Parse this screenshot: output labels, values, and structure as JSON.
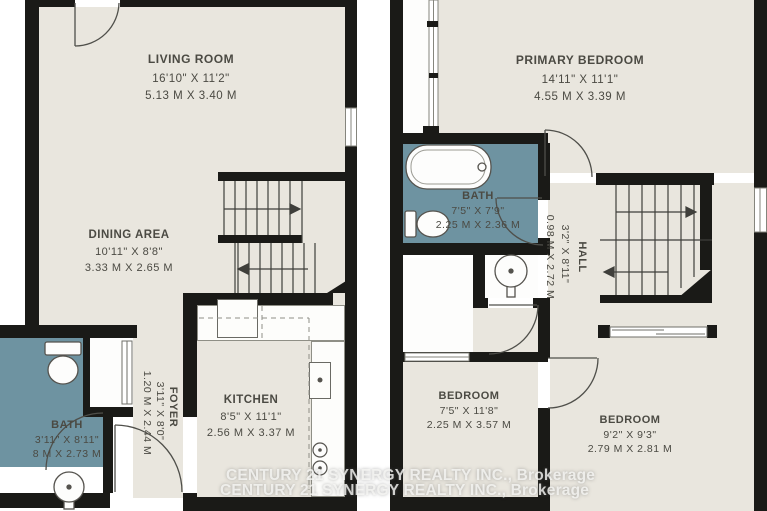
{
  "colors": {
    "floor": "#e9e6de",
    "wall": "#1a1a17",
    "bath_tile": "#6e93a1",
    "label_text": "#4b4a43",
    "watermark": "#f6f6f4"
  },
  "watermark": {
    "line1": "CENTURY 21 SYNERGY REALTY INC., Brokerage",
    "line2": "CENTURY 21 SYNERGY REALTY INC., Brokerage"
  },
  "floors": {
    "main": {
      "rooms": [
        {
          "id": "living-room",
          "name": "LIVING ROOM",
          "imperial": "16'10\" X 11'2\"",
          "metric": "5.13 M X 3.40 M"
        },
        {
          "id": "dining-area",
          "name": "DINING AREA",
          "imperial": "10'11\" X 8'8\"",
          "metric": "3.33 M X 2.65 M"
        },
        {
          "id": "kitchen",
          "name": "KITCHEN",
          "imperial": "8'5\" X 11'1\"",
          "metric": "2.56 M X 3.37 M"
        },
        {
          "id": "bath",
          "name": "BATH",
          "imperial": "3'11\" X 8'11\"",
          "metric": "8 M X 2.73 M"
        },
        {
          "id": "foyer",
          "name": "FOYER",
          "imperial": "3'11\" X 8'0\"",
          "metric": "1.20 M X 2.44 M"
        }
      ]
    },
    "upper": {
      "rooms": [
        {
          "id": "primary-bedroom",
          "name": "PRIMARY BEDROOM",
          "imperial": "14'11\" X 11'1\"",
          "metric": "4.55 M X 3.39 M"
        },
        {
          "id": "bath",
          "name": "BATH",
          "imperial": "7'5\" X 7'9\"",
          "metric": "2.25 M X 2.36 M"
        },
        {
          "id": "hall",
          "name": "HALL",
          "imperial": "3'2\" X 8'11\"",
          "metric": "0.98 M X 2.72 M"
        },
        {
          "id": "bedroom-middle",
          "name": "BEDROOM",
          "imperial": "7'5\" X 11'8\"",
          "metric": "2.25 M X 3.57 M"
        },
        {
          "id": "bedroom-right",
          "name": "BEDROOM",
          "imperial": "9'2\" X 9'3\"",
          "metric": "2.79 M X 2.81 M"
        }
      ]
    }
  }
}
